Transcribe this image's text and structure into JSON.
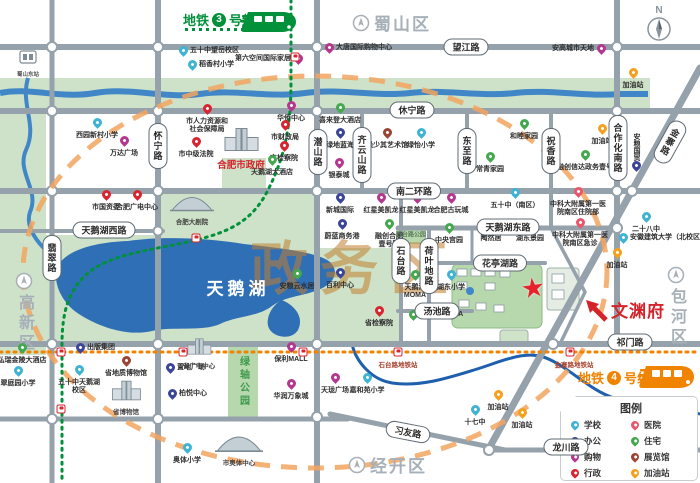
{
  "app": {
    "watermark": "政务区",
    "lake": "天鹅湖",
    "compass_n": "N"
  },
  "districts": {
    "shushan": "蜀山区",
    "gaoxin": "高新区",
    "baohe": "包河区",
    "jingkai": "经开区"
  },
  "project": {
    "name": "文渊府"
  },
  "shushan_east_station": {
    "label": "蜀山东站"
  },
  "metro": {
    "line3": {
      "prefix": "地铁",
      "num": "3",
      "suffix": "号线",
      "color": "#00913a"
    },
    "line4": {
      "prefix": "地铁",
      "num": "4",
      "suffix": "号线",
      "color": "#f08300"
    },
    "stations": [
      [
        295,
        57
      ],
      [
        196,
        238
      ],
      [
        61,
        352
      ],
      [
        183,
        352
      ],
      [
        303,
        352
      ],
      [
        398,
        352
      ],
      [
        570,
        352
      ],
      [
        61,
        409
      ]
    ],
    "station_labels": [
      {
        "label": "石台路地铁站",
        "x": 398,
        "y": 359
      },
      {
        "label": "金寨路地铁站",
        "x": 574,
        "y": 359
      }
    ]
  },
  "legend": {
    "title": "图例",
    "items": [
      {
        "label": "学校",
        "type": "school"
      },
      {
        "label": "医院",
        "type": "hospital"
      },
      {
        "label": "办公",
        "type": "office"
      },
      {
        "label": "住宅",
        "type": "home"
      },
      {
        "label": "购物",
        "type": "shop"
      },
      {
        "label": "展览馆",
        "type": "expo"
      },
      {
        "label": "行政",
        "type": "gov"
      },
      {
        "label": "加油站",
        "type": "gas"
      }
    ]
  },
  "colors": {
    "school": "#3fb3d4",
    "hospital": "#e8576b",
    "office": "#3a4499",
    "home": "#43a84e",
    "shop": "#b5368f",
    "expo": "#9c4434",
    "gov": "#d9232e",
    "gas": "#f5a01c"
  },
  "road_labels": {
    "h": [
      {
        "label": "望江路",
        "x": 466,
        "y": 47
      },
      {
        "label": "休宁路",
        "x": 412,
        "y": 110
      },
      {
        "label": "南二环路",
        "x": 414,
        "y": 191
      },
      {
        "label": "天鹅湖西路",
        "x": 104,
        "y": 230
      },
      {
        "label": "天鹅湖东路",
        "x": 508,
        "y": 227
      },
      {
        "label": "花亭湖路",
        "x": 500,
        "y": 263
      },
      {
        "label": "汤池路",
        "x": 437,
        "y": 311
      },
      {
        "label": "祁门路",
        "x": 630,
        "y": 342
      },
      {
        "label": "习友路",
        "x": 408,
        "y": 432,
        "rot": 11
      },
      {
        "label": "龙川路",
        "x": 566,
        "y": 447
      }
    ],
    "v": [
      {
        "label": "怀宁路",
        "x": 158,
        "y": 146
      },
      {
        "label": "潜山路",
        "x": 318,
        "y": 152
      },
      {
        "label": "齐云山路",
        "x": 362,
        "y": 155
      },
      {
        "label": "东至路",
        "x": 467,
        "y": 151
      },
      {
        "label": "祝香路",
        "x": 551,
        "y": 151
      },
      {
        "label": "合作化南路",
        "x": 618,
        "y": 148
      },
      {
        "label": "金寨路",
        "x": 670,
        "y": 142,
        "rot": 29
      },
      {
        "label": "翡翠路",
        "x": 52,
        "y": 258
      },
      {
        "label": "石台路",
        "x": 401,
        "y": 261
      },
      {
        "label": "荷叶地路",
        "x": 429,
        "y": 266
      }
    ]
  },
  "park_labels": [
    {
      "label": "绿轴公园",
      "x": 243,
      "y": 382,
      "vert": true,
      "color": "#3f9b4f",
      "size": 10
    },
    {
      "label": "石台路公园",
      "x": 411,
      "y": 234,
      "vert": false,
      "color": "#5a7a5a",
      "size": 6
    }
  ],
  "buildings": [
    {
      "label": "合肥市政府",
      "x": 241,
      "y": 142,
      "shape": "towers",
      "red": true,
      "scale": 1
    },
    {
      "label": "合肥大剧院",
      "x": 192,
      "y": 205,
      "shape": "dome",
      "scale": 1
    },
    {
      "label": "省博物馆",
      "x": 126,
      "y": 393,
      "shape": "towers",
      "scale": 0.85
    },
    {
      "label": "省广电中心",
      "x": 199,
      "y": 349,
      "shape": "towers",
      "scale": 0.7
    },
    {
      "label": "市奥体中心",
      "x": 239,
      "y": 445,
      "shape": "dome",
      "scale": 1.1
    }
  ],
  "pois": [
    {
      "label": "五十中望岳校区",
      "x": 183,
      "y": 57,
      "t": "school",
      "lp": "right"
    },
    {
      "label": "稻香村小学",
      "x": 192,
      "y": 71,
      "t": "school",
      "lp": "right"
    },
    {
      "label": "第六空间国际家居",
      "x": 298,
      "y": 65,
      "t": "shop",
      "lp": "left"
    },
    {
      "label": "大唐国际购物中心",
      "x": 329,
      "y": 54,
      "t": "shop",
      "lp": "right"
    },
    {
      "label": "安高城市天地",
      "x": 601,
      "y": 55,
      "t": "shop",
      "lp": "left"
    },
    {
      "label": "加油站",
      "x": 633,
      "y": 79,
      "t": "gas"
    },
    {
      "label": "加油站",
      "x": 602,
      "y": 135,
      "t": "gas"
    },
    {
      "label": "西园新村小学",
      "x": 97,
      "y": 129,
      "t": "school"
    },
    {
      "label": "万达广场",
      "x": 124,
      "y": 147,
      "t": "shop"
    },
    {
      "label": "市人力资源和社会保障局",
      "x": 207,
      "y": 115,
      "t": "gov",
      "w": 48
    },
    {
      "label": "市中级法院",
      "x": 196,
      "y": 148,
      "t": "gov"
    },
    {
      "label": "华侨中心",
      "x": 291,
      "y": 112,
      "t": "shop"
    },
    {
      "label": "市财政局",
      "x": 285,
      "y": 131,
      "t": "gov"
    },
    {
      "label": "市检察院",
      "x": 284,
      "y": 152,
      "t": "gov"
    },
    {
      "label": "喜来登大酒店",
      "x": 340,
      "y": 114,
      "t": "home"
    },
    {
      "label": "绿地蓝海",
      "x": 340,
      "y": 139,
      "t": "office"
    },
    {
      "label": "银泰城",
      "x": 339,
      "y": 169,
      "t": "shop"
    },
    {
      "label": "赖少其艺术馆",
      "x": 387,
      "y": 139,
      "t": "expo"
    },
    {
      "label": "绿怡小学",
      "x": 421,
      "y": 139,
      "t": "school"
    },
    {
      "label": "和睦家园",
      "x": 524,
      "y": 130,
      "t": "home"
    },
    {
      "label": "常青家园",
      "x": 490,
      "y": 163,
      "t": "home"
    },
    {
      "label": "天鹅湖大酒店",
      "x": 272,
      "y": 166,
      "t": "home"
    },
    {
      "label": "融创信达政务壹号",
      "x": 585,
      "y": 161,
      "t": "home"
    },
    {
      "label": "安粮国贸",
      "x": 636,
      "y": 172,
      "t": "office",
      "lp": "vup"
    },
    {
      "label": "市国资委",
      "x": 106,
      "y": 201,
      "t": "gov"
    },
    {
      "label": "合肥广电中心",
      "x": 137,
      "y": 201,
      "t": "gov"
    },
    {
      "label": "新城国际",
      "x": 340,
      "y": 204,
      "t": "office"
    },
    {
      "label": "红星美凯龙",
      "x": 381,
      "y": 204,
      "t": "shop"
    },
    {
      "label": "红星美凯龙",
      "x": 417,
      "y": 204,
      "t": "shop"
    },
    {
      "label": "合肥古玩城",
      "x": 451,
      "y": 204,
      "t": "shop"
    },
    {
      "label": "五十中（南区）",
      "x": 515,
      "y": 199,
      "t": "school"
    },
    {
      "label": "中科大附属第一医院南区住院部",
      "x": 578,
      "y": 198,
      "t": "hospital",
      "w": 58
    },
    {
      "label": "中科大附属第一医院南区急诊",
      "x": 580,
      "y": 229,
      "t": "hospital",
      "w": 58
    },
    {
      "label": "二十八中",
      "x": 646,
      "y": 223,
      "t": "school"
    },
    {
      "label": "安徽建筑大学（北校区）",
      "x": 623,
      "y": 244,
      "t": "school",
      "lp": "right"
    },
    {
      "label": "加油站",
      "x": 617,
      "y": 259,
      "t": "gas"
    },
    {
      "label": "蔚蓝商务港",
      "x": 342,
      "y": 230,
      "t": "office"
    },
    {
      "label": "融创合肥壹号院",
      "x": 389,
      "y": 230,
      "t": "home",
      "w": 34
    },
    {
      "label": "中央宫园",
      "x": 449,
      "y": 234,
      "t": "home"
    },
    {
      "label": "陶然居",
      "x": 491,
      "y": 232,
      "t": "home"
    },
    {
      "label": "湖东景园",
      "x": 530,
      "y": 232,
      "t": "home"
    },
    {
      "label": "百利中心",
      "x": 340,
      "y": 279,
      "t": "office"
    },
    {
      "label": "安粮云水居",
      "x": 297,
      "y": 280,
      "t": "home"
    },
    {
      "label": "天鹅湖MOMA",
      "x": 415,
      "y": 281,
      "t": "home",
      "w": 34
    },
    {
      "label": "湖东小学",
      "x": 451,
      "y": 281,
      "t": "school"
    },
    {
      "label": "省检察院",
      "x": 379,
      "y": 317,
      "t": "gov"
    },
    {
      "label": "天鹅湖MOMA",
      "x": 413,
      "y": 321,
      "t": "home",
      "lp": "right"
    },
    {
      "label": "弘瑞金陵大酒店",
      "x": 22,
      "y": 354,
      "t": "home"
    },
    {
      "label": "翠庭园小学",
      "x": 18,
      "y": 377,
      "t": "school"
    },
    {
      "label": "出版集团",
      "x": 80,
      "y": 354,
      "t": "office",
      "lp": "right"
    },
    {
      "label": "五十中天鹅湖校区",
      "x": 79,
      "y": 376,
      "t": "school",
      "w": 46
    },
    {
      "label": "省地质博物馆",
      "x": 126,
      "y": 367,
      "t": "expo"
    },
    {
      "label": "置地广场",
      "x": 170,
      "y": 374,
      "t": "office",
      "lp": "right"
    },
    {
      "label": "柏悦中心",
      "x": 172,
      "y": 400,
      "t": "office",
      "lp": "right"
    },
    {
      "label": "奥体小学",
      "x": 187,
      "y": 454,
      "t": "school"
    },
    {
      "label": "保利MALL",
      "x": 291,
      "y": 353,
      "t": "shop"
    },
    {
      "label": "华润万象城",
      "x": 291,
      "y": 390,
      "t": "shop"
    },
    {
      "label": "天珑广场",
      "x": 335,
      "y": 384,
      "t": "shop"
    },
    {
      "label": "嘉和苑小学",
      "x": 367,
      "y": 384,
      "t": "school"
    },
    {
      "label": "十七中",
      "x": 475,
      "y": 416,
      "t": "school"
    },
    {
      "label": "加油站",
      "x": 498,
      "y": 401,
      "t": "gas"
    },
    {
      "label": "加油站",
      "x": 522,
      "y": 419,
      "t": "gas"
    }
  ]
}
